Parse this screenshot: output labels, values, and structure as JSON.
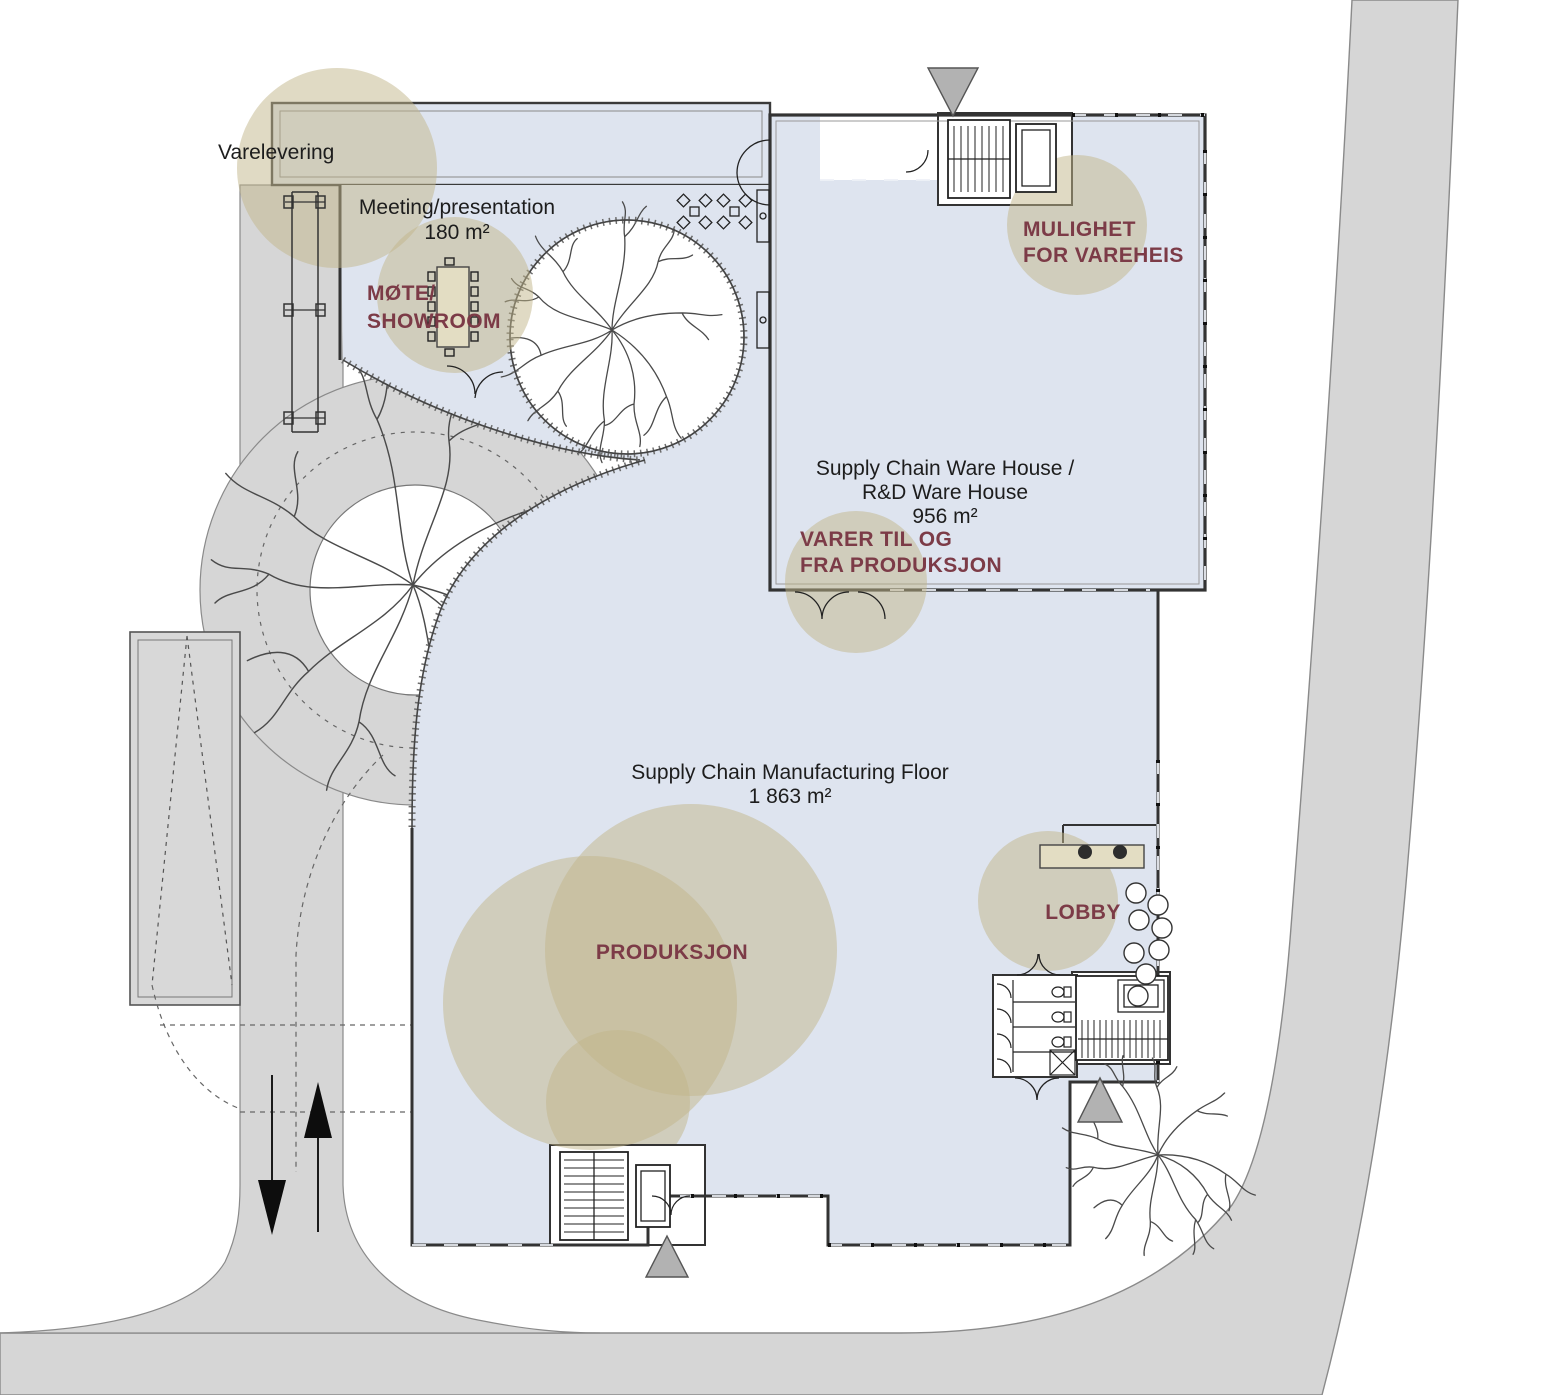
{
  "plan_title": "Site / floor plan",
  "colors": {
    "floor_fill": "#dee4ef",
    "road_fill": "#d6d6d6",
    "highlight_circle": "rgba(193,181,137,0.5)",
    "annotation_text": "#7c3b47",
    "wall_stroke": "#333333",
    "furniture_tan": "#e3ddc3"
  },
  "labels": {
    "varelevering": "Varelevering",
    "meeting_name": "Meeting/presentation",
    "meeting_area": "180 m²",
    "mote_line1": "MØTE/",
    "mote_line2": "SHOWROOM",
    "vareheis_line1": "MULIGHET",
    "vareheis_line2": "FOR VAREHEIS",
    "warehouse_line1": "Supply Chain Ware House /",
    "warehouse_line2": "R&D Ware House",
    "warehouse_area": "956 m²",
    "varer_line1": "VARER TIL OG",
    "varer_line2": "FRA PRODUKSJON",
    "manufacturing_name": "Supply Chain Manufacturing Floor",
    "manufacturing_area": "1 863 m²",
    "produksjon": "PRODUKSJON",
    "lobby": "LOBBY"
  }
}
